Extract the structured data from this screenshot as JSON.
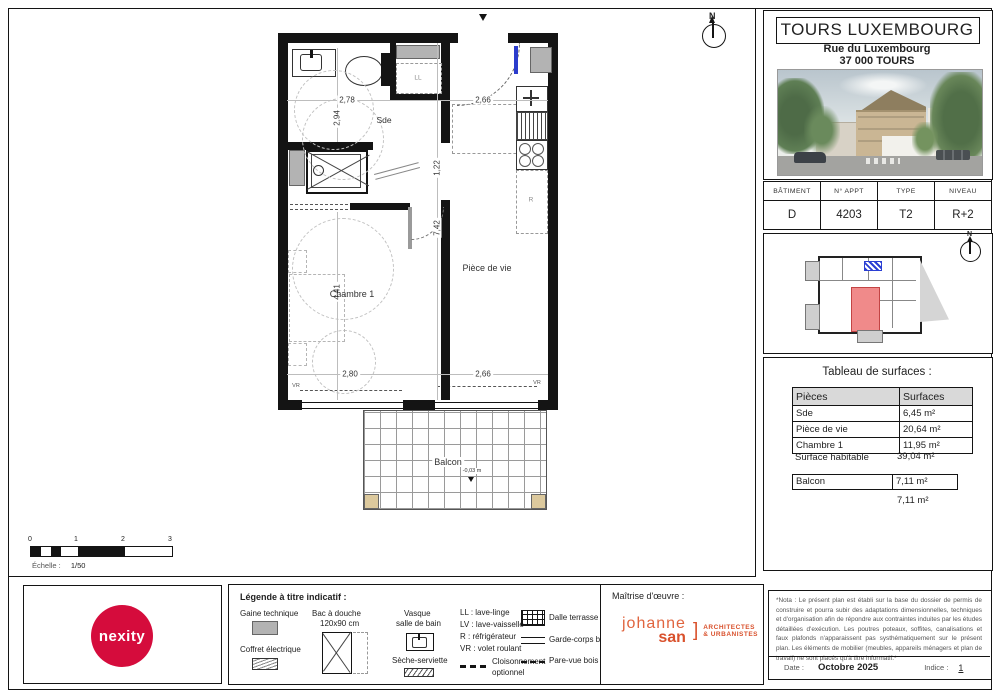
{
  "header": {
    "title": "TOURS LUXEMBOURG",
    "address1": "Rue du Luxembourg",
    "address2": "37 000 TOURS"
  },
  "info_table": {
    "h0": "BÂTIMENT",
    "v0": "D",
    "h1": "N° APPT",
    "v1": "4203",
    "h2": "TYPE",
    "v2": "T2",
    "h3": "NIVEAU",
    "v3": "R+2"
  },
  "key_plan": {
    "north": "N"
  },
  "surfaces": {
    "title": "Tableau de surfaces :",
    "col_piece": "Pièces",
    "col_surface": "Surfaces",
    "rows": [
      {
        "piece": "Sde",
        "surface": "6,45 m²"
      },
      {
        "piece": "Pièce de vie",
        "surface": "20,64 m²"
      },
      {
        "piece": "Chambre 1",
        "surface": "11,95 m²"
      }
    ],
    "habitable_label": "Surface habitable",
    "habitable_value": "39,04 m²",
    "balcon_label": "Balcon",
    "balcon_value": "7,11 m²",
    "balcon_total": "7,11 m²"
  },
  "plan": {
    "north": "N",
    "rooms": {
      "sde": "Sde",
      "chambre": "Chambre 1",
      "piece": "Pièce de vie",
      "balcon": "Balcon"
    },
    "dims": {
      "sde_w": "2,78",
      "sde_h": "2,94",
      "entry_w": "2,66",
      "hall": "1,22",
      "piece_h": "7,42",
      "chambre_h": "4,41",
      "chambre_w": "2,80",
      "piece_w": "2,66",
      "balcon_w": "3,72",
      "balcon_h": "1,92"
    },
    "level": "-0,03 m",
    "ll": "LL",
    "r": "R",
    "vr_left": "VR",
    "vr_right": "VR"
  },
  "scale_bar": {
    "t0": "0",
    "t1": "1",
    "t2": "2",
    "t3": "3",
    "label": "Échelle :",
    "value": "1/50"
  },
  "nexity": {
    "logo": "nexity"
  },
  "legend": {
    "title": "Légende à titre indicatif :",
    "gaine": "Gaine technique",
    "coffret": "Coffret électrique",
    "bac1": "Bac à douche",
    "bac2": "120x90 cm",
    "vasque1": "Vasque",
    "vasque2": "salle de bain",
    "seche": "Sèche-serviette",
    "ll": "LL : lave-linge",
    "lv": "LV : lave-vaisselle",
    "r": "R : réfrigérateur",
    "vr": "VR : volet roulant",
    "cloison1": "Cloisonnement",
    "cloison2": "optionnel",
    "dalle": "Dalle terrasse",
    "garde": "Garde-corps bois",
    "pare": "Pare-vue bois"
  },
  "maitrise": {
    "title": "Maîtrise d'œuvre :",
    "logo1": "johanne",
    "logo2": "san",
    "bracket": "]",
    "sub1": "ARCHITECTES",
    "sub2": "& URBANISTES"
  },
  "nota": {
    "text": "*Nota : Le présent plan est établi sur la base du dossier de permis de construire et pourra subir des adaptations dimensionnelles, techniques et d'organisation afin de répondre aux contraintes induites par les études détaillées d'exécution. Les poutres poteaux, soffites, canalisations et faux plafonds n'apparaissent pas systhématiquement sur le présent plan. Les éléments de mobilier (meubles, appareils ménagers et plan de travail) ne sont placés qu'à titre informatif.*",
    "date_label": "Date :",
    "date_value": "Octobre 2025",
    "indice_label": "Indice :",
    "indice_value": "1"
  },
  "colors": {
    "nexity_red": "#d50c3c",
    "architect_orange": "#d9512c",
    "unit_highlight": "#f08a8a"
  }
}
